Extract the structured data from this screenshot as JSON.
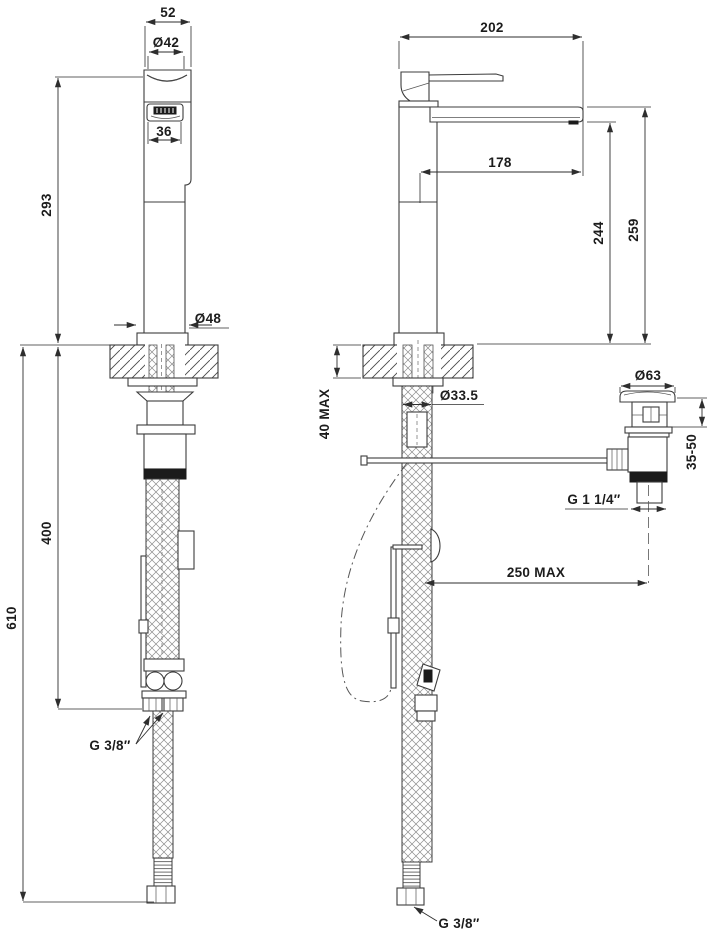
{
  "page": {
    "background": "#ffffff",
    "line_color": "#3c3c3c",
    "text_color": "#1c1c1c"
  },
  "drawing": {
    "type": "faucet-installation-technical-drawing",
    "views": [
      "front-view",
      "side-view",
      "waste-drain-detail"
    ],
    "dims": {
      "front": {
        "top_width": "52",
        "handle_dia": "Ø42",
        "logo_window_width": "36",
        "height_above_deck": "293",
        "base_dia": "Ø48",
        "supply_length": "400",
        "total_below_deck": "610",
        "supply_thread": "G 3/8″"
      },
      "side": {
        "total_depth": "202",
        "spout_reach": "178",
        "spout_bottom_height": "244",
        "outlet_height": "259",
        "deck_thickness_max": "40 MAX",
        "shank_dia": "Ø33.5",
        "waste_flange_dia": "Ø63",
        "waste_deck_range": "35-50",
        "waste_thread": "G 1 1/4″",
        "waste_offset_max": "250 MAX",
        "supply_thread": "G 3/8″"
      }
    }
  }
}
